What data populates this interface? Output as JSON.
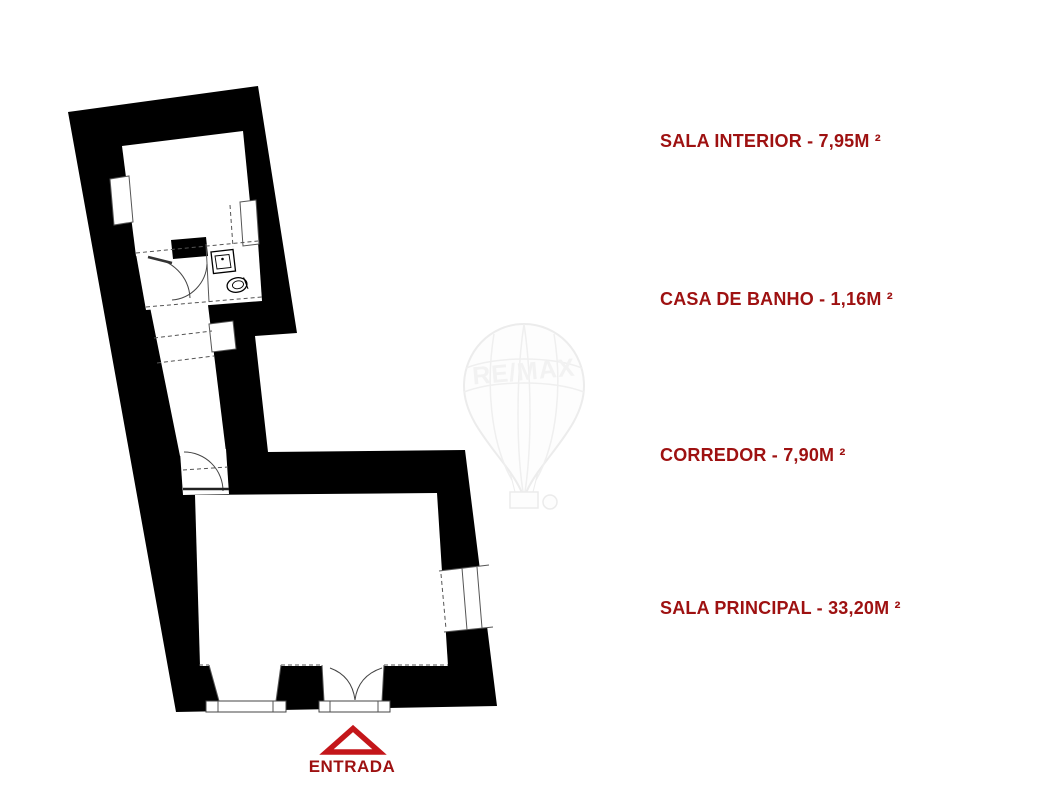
{
  "colors": {
    "wall": "#000000",
    "floor": "#ffffff",
    "label_red": "#9e1111",
    "entrance_red": "#c4161a"
  },
  "legend": {
    "items": [
      {
        "room": "sala-interior",
        "text": "SALA INTERIOR - 7,95M ²"
      },
      {
        "room": "casa-de-banho",
        "text": "CASA DE BANHO - 1,16M ²"
      },
      {
        "room": "corredor",
        "text": "CORREDOR - 7,90M ²"
      },
      {
        "room": "sala-principal",
        "text": "SALA PRINCIPAL - 33,20M ²"
      }
    ]
  },
  "entrance": {
    "label": "ENTRADA"
  },
  "watermark": {
    "brand": "RE/MAX"
  }
}
